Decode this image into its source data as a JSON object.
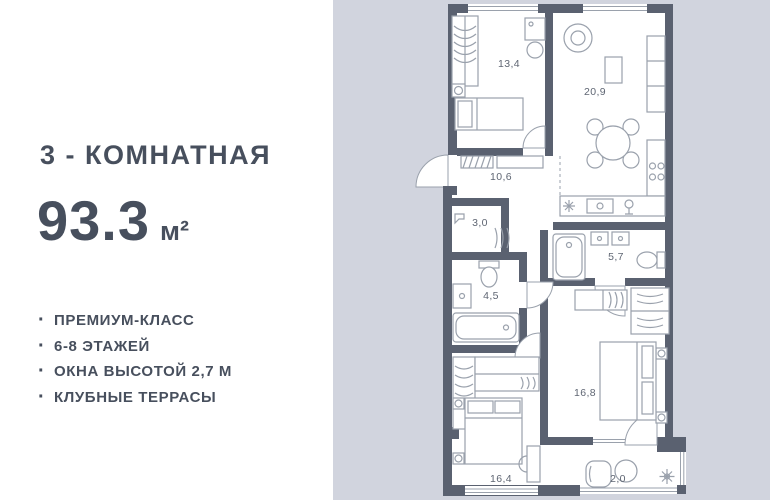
{
  "left_panel": {
    "title": "3 - КОМНАТНАЯ",
    "area": {
      "value": "93.3",
      "unit": "м²"
    },
    "bullet": "·",
    "features": [
      {
        "label": "ПРЕМИУМ-КЛАСС"
      },
      {
        "label": "6-8 ЭТАЖЕЙ"
      },
      {
        "label": "ОКНА ВЫСОТОЙ 2,7 М"
      },
      {
        "label": "КЛУБНЫЕ ТЕРРАСЫ"
      }
    ]
  },
  "floorplan": {
    "rooms": [
      {
        "name": "bedroom-top",
        "area": "13,4"
      },
      {
        "name": "living-kitchen",
        "area": "20,9"
      },
      {
        "name": "hallway",
        "area": "10,6"
      },
      {
        "name": "wardrobe-closet",
        "area": "3,0"
      },
      {
        "name": "bathroom-small",
        "area": "4,5"
      },
      {
        "name": "bathroom-large",
        "area": "5,7"
      },
      {
        "name": "bedroom-right",
        "area": "16,8"
      },
      {
        "name": "bedroom-bottom",
        "area": "16,4"
      },
      {
        "name": "balcony",
        "area": "2,0"
      }
    ],
    "colors": {
      "background": "#d1d4de",
      "walls": "#5a6170",
      "floor": "#ffffff",
      "furniture": "#9aa1ac",
      "room_label": "#5f6673",
      "panel_text": "#474f5d"
    }
  }
}
